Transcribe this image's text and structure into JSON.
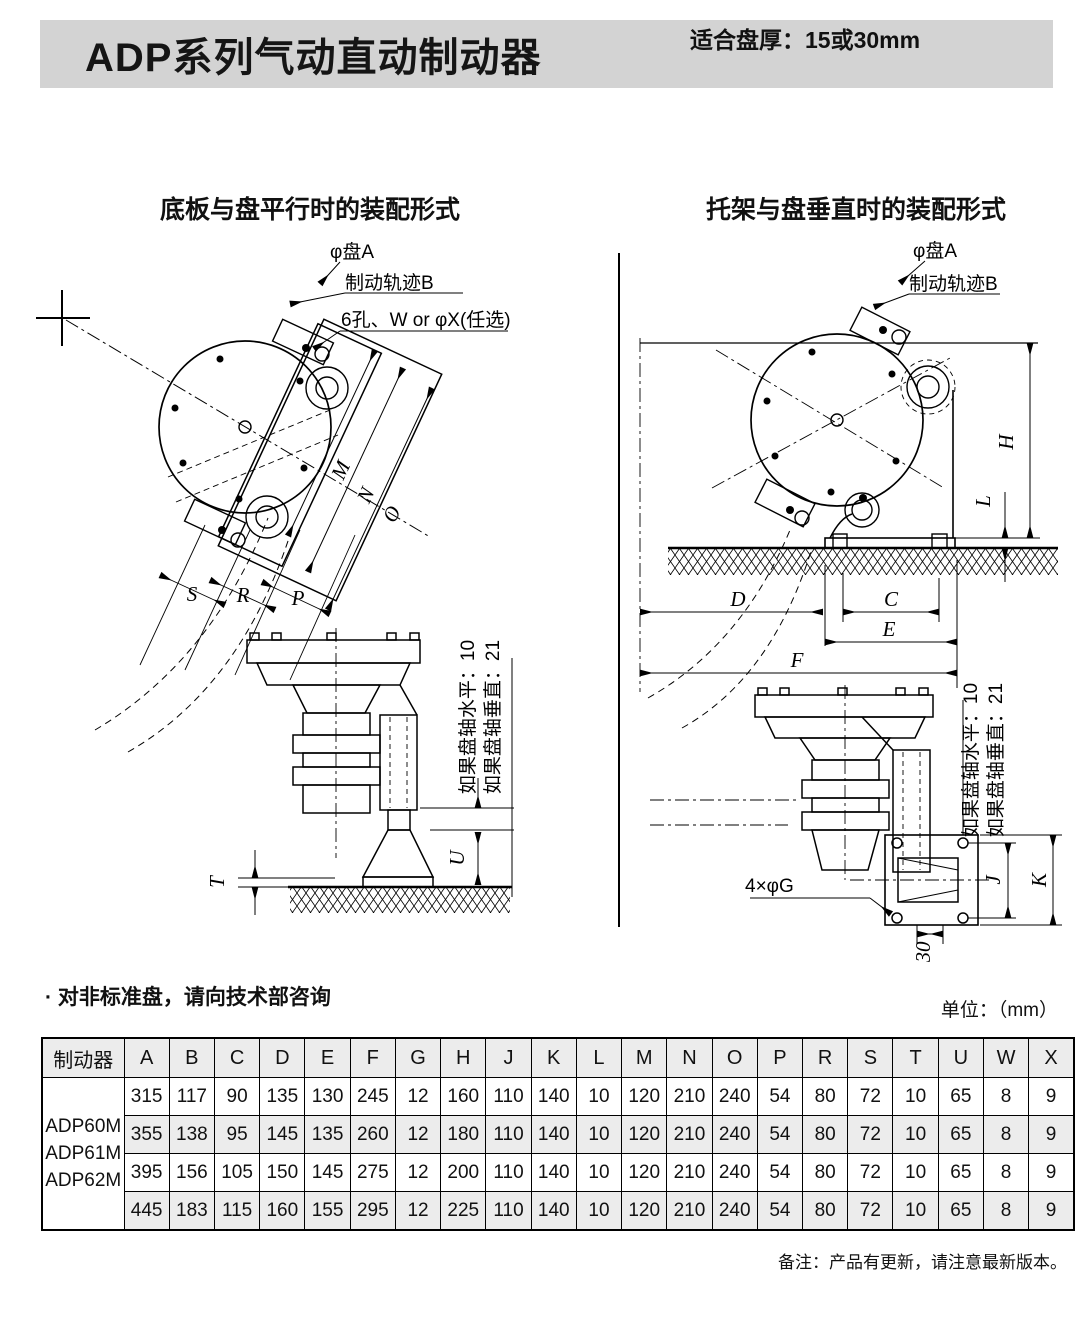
{
  "header": {
    "title": "ADP系列气动直动制动器",
    "disc_thickness_label": "适合盘厚：",
    "disc_thickness_value": "15或30mm"
  },
  "diagrams": {
    "left": {
      "title": "底板与盘平行时的装配形式",
      "labels": {
        "disc_a": "φ盘A",
        "brake_track_b": "制动轨迹B",
        "holes": "6孔、W or φX(任选)",
        "dim_m": "M",
        "dim_n": "N",
        "dim_o": "O",
        "dim_s": "S",
        "dim_r": "R",
        "dim_p": "P",
        "dim_t": "T",
        "dim_u": "U",
        "axis_horizontal_note": "如果盘轴水平：10",
        "axis_vertical_note": "如果盘轴垂直：21"
      }
    },
    "right": {
      "title": "托架与盘垂直时的装配形式",
      "labels": {
        "disc_a": "φ盘A",
        "brake_track_b": "制动轨迹B",
        "dim_h": "H",
        "dim_l": "L",
        "dim_d": "D",
        "dim_c": "C",
        "dim_e": "E",
        "dim_f": "F",
        "dim_j": "J",
        "dim_k": "K",
        "bolt_holes": "4×φG",
        "dim_30": "30",
        "axis_horizontal_note": "如果盘轴水平：10",
        "axis_vertical_note": "如果盘轴垂直：21"
      }
    }
  },
  "notes": {
    "nonstandard": "· 对非标准盘，请向技术部咨询",
    "unit": "单位：（mm）",
    "remark": "备注：产品有更新，请注意最新版本。"
  },
  "table": {
    "header_col": "制动器",
    "columns": [
      "A",
      "B",
      "C",
      "D",
      "E",
      "F",
      "G",
      "H",
      "J",
      "K",
      "L",
      "M",
      "N",
      "O",
      "P",
      "R",
      "S",
      "T",
      "U",
      "W",
      "X"
    ],
    "models": [
      "ADP60M",
      "ADP61M",
      "ADP62M"
    ],
    "rows": [
      [
        315,
        117,
        90,
        135,
        130,
        245,
        12,
        160,
        110,
        140,
        10,
        120,
        210,
        240,
        54,
        80,
        72,
        10,
        65,
        8,
        9
      ],
      [
        355,
        138,
        95,
        145,
        135,
        260,
        12,
        180,
        110,
        140,
        10,
        120,
        210,
        240,
        54,
        80,
        72,
        10,
        65,
        8,
        9
      ],
      [
        395,
        156,
        105,
        150,
        145,
        275,
        12,
        200,
        110,
        140,
        10,
        120,
        210,
        240,
        54,
        80,
        72,
        10,
        65,
        8,
        9
      ],
      [
        445,
        183,
        115,
        160,
        155,
        295,
        12,
        225,
        110,
        140,
        10,
        120,
        210,
        240,
        54,
        80,
        72,
        10,
        65,
        8,
        9
      ]
    ]
  },
  "colors": {
    "header_bar_bg": "#d3d3d3",
    "table_shade": "#ececec",
    "line": "#000000",
    "background": "#ffffff"
  }
}
